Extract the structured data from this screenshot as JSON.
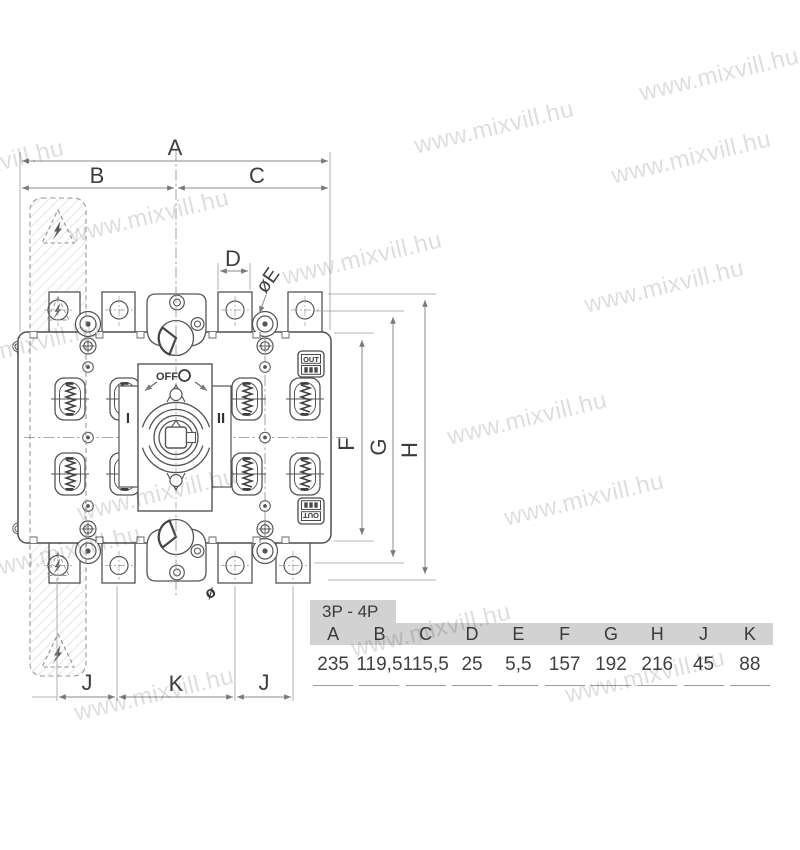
{
  "watermark": {
    "text": "www.mixvill.hu"
  },
  "drawing": {
    "dimensions": {
      "a": "A",
      "b": "B",
      "c": "C",
      "d": "D",
      "e": "øE",
      "f": "F",
      "g": "G",
      "h": "H",
      "j": "J",
      "k": "K",
      "diameter_mark": "ø"
    },
    "switch": {
      "off_label": "OFF",
      "position_1": "I",
      "position_2": "II",
      "out_label": "OUT"
    }
  },
  "table": {
    "title": "3P - 4P",
    "columns": [
      "A",
      "B",
      "C",
      "D",
      "E",
      "F",
      "G",
      "H",
      "J",
      "K"
    ],
    "values": [
      "235",
      "119,5",
      "115,5",
      "25",
      "5,5",
      "157",
      "192",
      "216",
      "45",
      "88"
    ]
  },
  "colors": {
    "line": "#555555",
    "dim_line": "#8a8a8a",
    "label_text": "#3d3d3d",
    "table_header_bg": "#d2d2d2",
    "watermark": "#dcdcdc"
  }
}
